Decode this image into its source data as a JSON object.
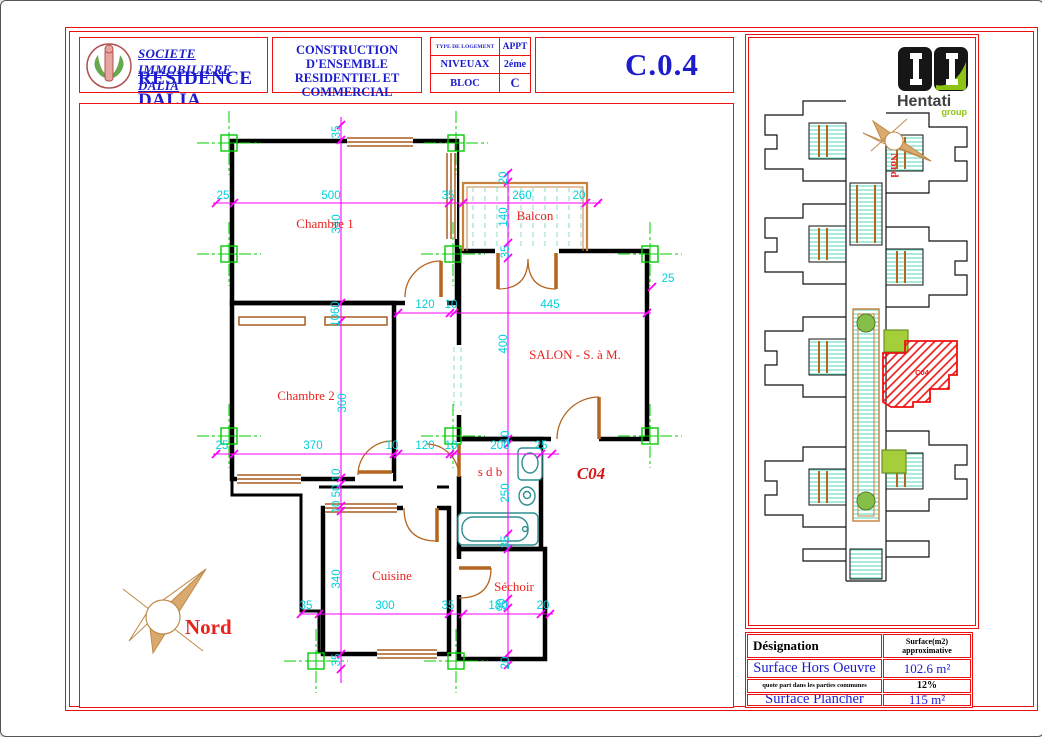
{
  "title_block": {
    "company": "SOCIETE  IMMOBILIERE DALIA",
    "residence": "RESIDENCE DALIA",
    "project_line1": "CONSTRUCTION D'ENSEMBLE",
    "project_line2": "RESIDENTIEL ET COMMERCIAL",
    "location_prefix": "sis à",
    "location": "EZZAHROUNI",
    "type_label": "TYPE DE LOGEMENT",
    "type_value": "APPT",
    "level_label": "NIVEUAX",
    "level_value": "2éme",
    "bloc_label": "BLOC",
    "bloc_value": "C",
    "drawing_number": "C.0.4"
  },
  "plan": {
    "apartment_code": "C04",
    "north_label": "Nord",
    "rooms": [
      {
        "t": "Chambre 1",
        "x": 324,
        "y": 227
      },
      {
        "t": "Balcon",
        "x": 534,
        "y": 219
      },
      {
        "t": "SALON - S. à M.",
        "x": 574,
        "y": 358
      },
      {
        "t": "Chambre 2",
        "x": 305,
        "y": 399
      },
      {
        "t": "s d b",
        "x": 489,
        "y": 475
      },
      {
        "t": "Cuisine",
        "x": 391,
        "y": 579
      },
      {
        "t": "Séchoir",
        "x": 513,
        "y": 590
      }
    ],
    "dimensions": [
      {
        "t": "25",
        "x": 222,
        "y": 198
      },
      {
        "t": "500",
        "x": 330,
        "y": 198
      },
      {
        "t": "35",
        "x": 447,
        "y": 198
      },
      {
        "t": "260",
        "x": 521,
        "y": 198
      },
      {
        "t": "20",
        "x": 578,
        "y": 198
      },
      {
        "t": "20",
        "x": 506,
        "y": 177,
        "r": 1
      },
      {
        "t": "140",
        "x": 506,
        "y": 216,
        "r": 1
      },
      {
        "t": "120",
        "x": 424,
        "y": 307
      },
      {
        "t": "10",
        "x": 450,
        "y": 307
      },
      {
        "t": "445",
        "x": 549,
        "y": 307
      },
      {
        "t": "1060",
        "x": 338,
        "y": 313,
        "r": 1
      },
      {
        "t": "25",
        "x": 221,
        "y": 448
      },
      {
        "t": "370",
        "x": 312,
        "y": 448
      },
      {
        "t": "10",
        "x": 391,
        "y": 448
      },
      {
        "t": "120",
        "x": 424,
        "y": 448
      },
      {
        "t": "10",
        "x": 450,
        "y": 448
      },
      {
        "t": "200",
        "x": 499,
        "y": 448
      },
      {
        "t": "25",
        "x": 540,
        "y": 448
      },
      {
        "t": "35",
        "x": 305,
        "y": 608
      },
      {
        "t": "300",
        "x": 384,
        "y": 608
      },
      {
        "t": "35",
        "x": 447,
        "y": 608
      },
      {
        "t": "180",
        "x": 497,
        "y": 608
      },
      {
        "t": "20",
        "x": 542,
        "y": 608
      },
      {
        "t": "35",
        "x": 339,
        "y": 131,
        "r": 1
      },
      {
        "t": "340",
        "x": 339,
        "y": 223,
        "r": 1
      },
      {
        "t": "360",
        "x": 345,
        "y": 402,
        "r": 1
      },
      {
        "t": "10",
        "x": 339,
        "y": 474,
        "r": 1
      },
      {
        "t": "50",
        "x": 339,
        "y": 490,
        "r": 1
      },
      {
        "t": "10",
        "x": 339,
        "y": 506,
        "r": 1
      },
      {
        "t": "340",
        "x": 339,
        "y": 578,
        "r": 1
      },
      {
        "t": "35",
        "x": 339,
        "y": 659,
        "r": 1
      },
      {
        "t": "35",
        "x": 508,
        "y": 251,
        "r": 1
      },
      {
        "t": "400",
        "x": 506,
        "y": 343,
        "r": 1
      },
      {
        "t": "10",
        "x": 508,
        "y": 436,
        "r": 1
      },
      {
        "t": "250",
        "x": 508,
        "y": 492,
        "r": 1
      },
      {
        "t": "35",
        "x": 508,
        "y": 541,
        "r": 1
      },
      {
        "t": "90",
        "x": 504,
        "y": 604,
        "r": 1
      },
      {
        "t": "20",
        "x": 508,
        "y": 662,
        "r": 1
      },
      {
        "t": "25",
        "x": 667,
        "y": 281
      }
    ]
  },
  "site": {
    "north_label": "Nord",
    "unit_code": "C04",
    "logo": {
      "name": "Hentati",
      "sub": "group"
    }
  },
  "surface_table": {
    "col1_header": "Désignation",
    "col2_header_line1": "Surface(m2)",
    "col2_header_line2": "approximative",
    "rows": [
      {
        "label": "Surface  Hors Oeuvre",
        "value": "102.6 m²"
      },
      {
        "label": "quote part dans les parties communes",
        "value": "12%"
      },
      {
        "label": "Surface  Plancher",
        "value": "115 m²"
      }
    ]
  }
}
